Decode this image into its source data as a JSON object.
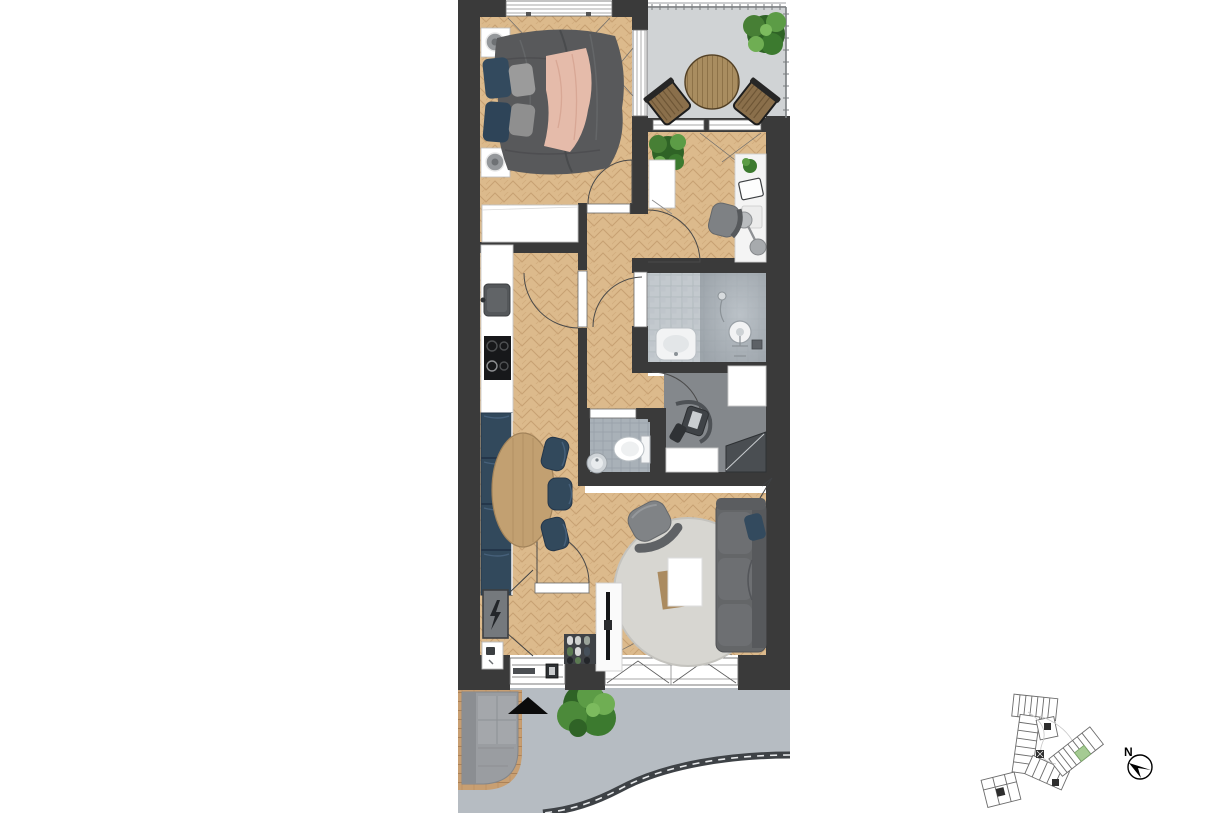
{
  "compass": {
    "label": "N"
  },
  "colors": {
    "wall": "#3a3a3a",
    "wood": "#dcba8c",
    "wood_line": "#c7a173",
    "balcony_floor": "#d0d3d5",
    "tile_light": "#c6ccd1",
    "tile_dark": "#9aa2a9",
    "storage_floor": "#84888c",
    "wc_tile": "#a9b1b8",
    "pavement": "#b6bcc2",
    "deck_wood": "#c89f72",
    "bed_gray": "#58595b",
    "blanket_pink": "#e5bbaa",
    "pillow_blue": "#334a5e",
    "pillow_gray": "#9b9b9b",
    "dining_navy": "#32495c",
    "table_wood": "#c2a071",
    "rug": "#d7d6d1",
    "sofa_gray": "#646668",
    "plant_green": "#4c8a3a",
    "plant_dark": "#2f6326",
    "highlight_green": "#a5cb93",
    "curb": "#3e4246",
    "white": "#ffffff"
  }
}
